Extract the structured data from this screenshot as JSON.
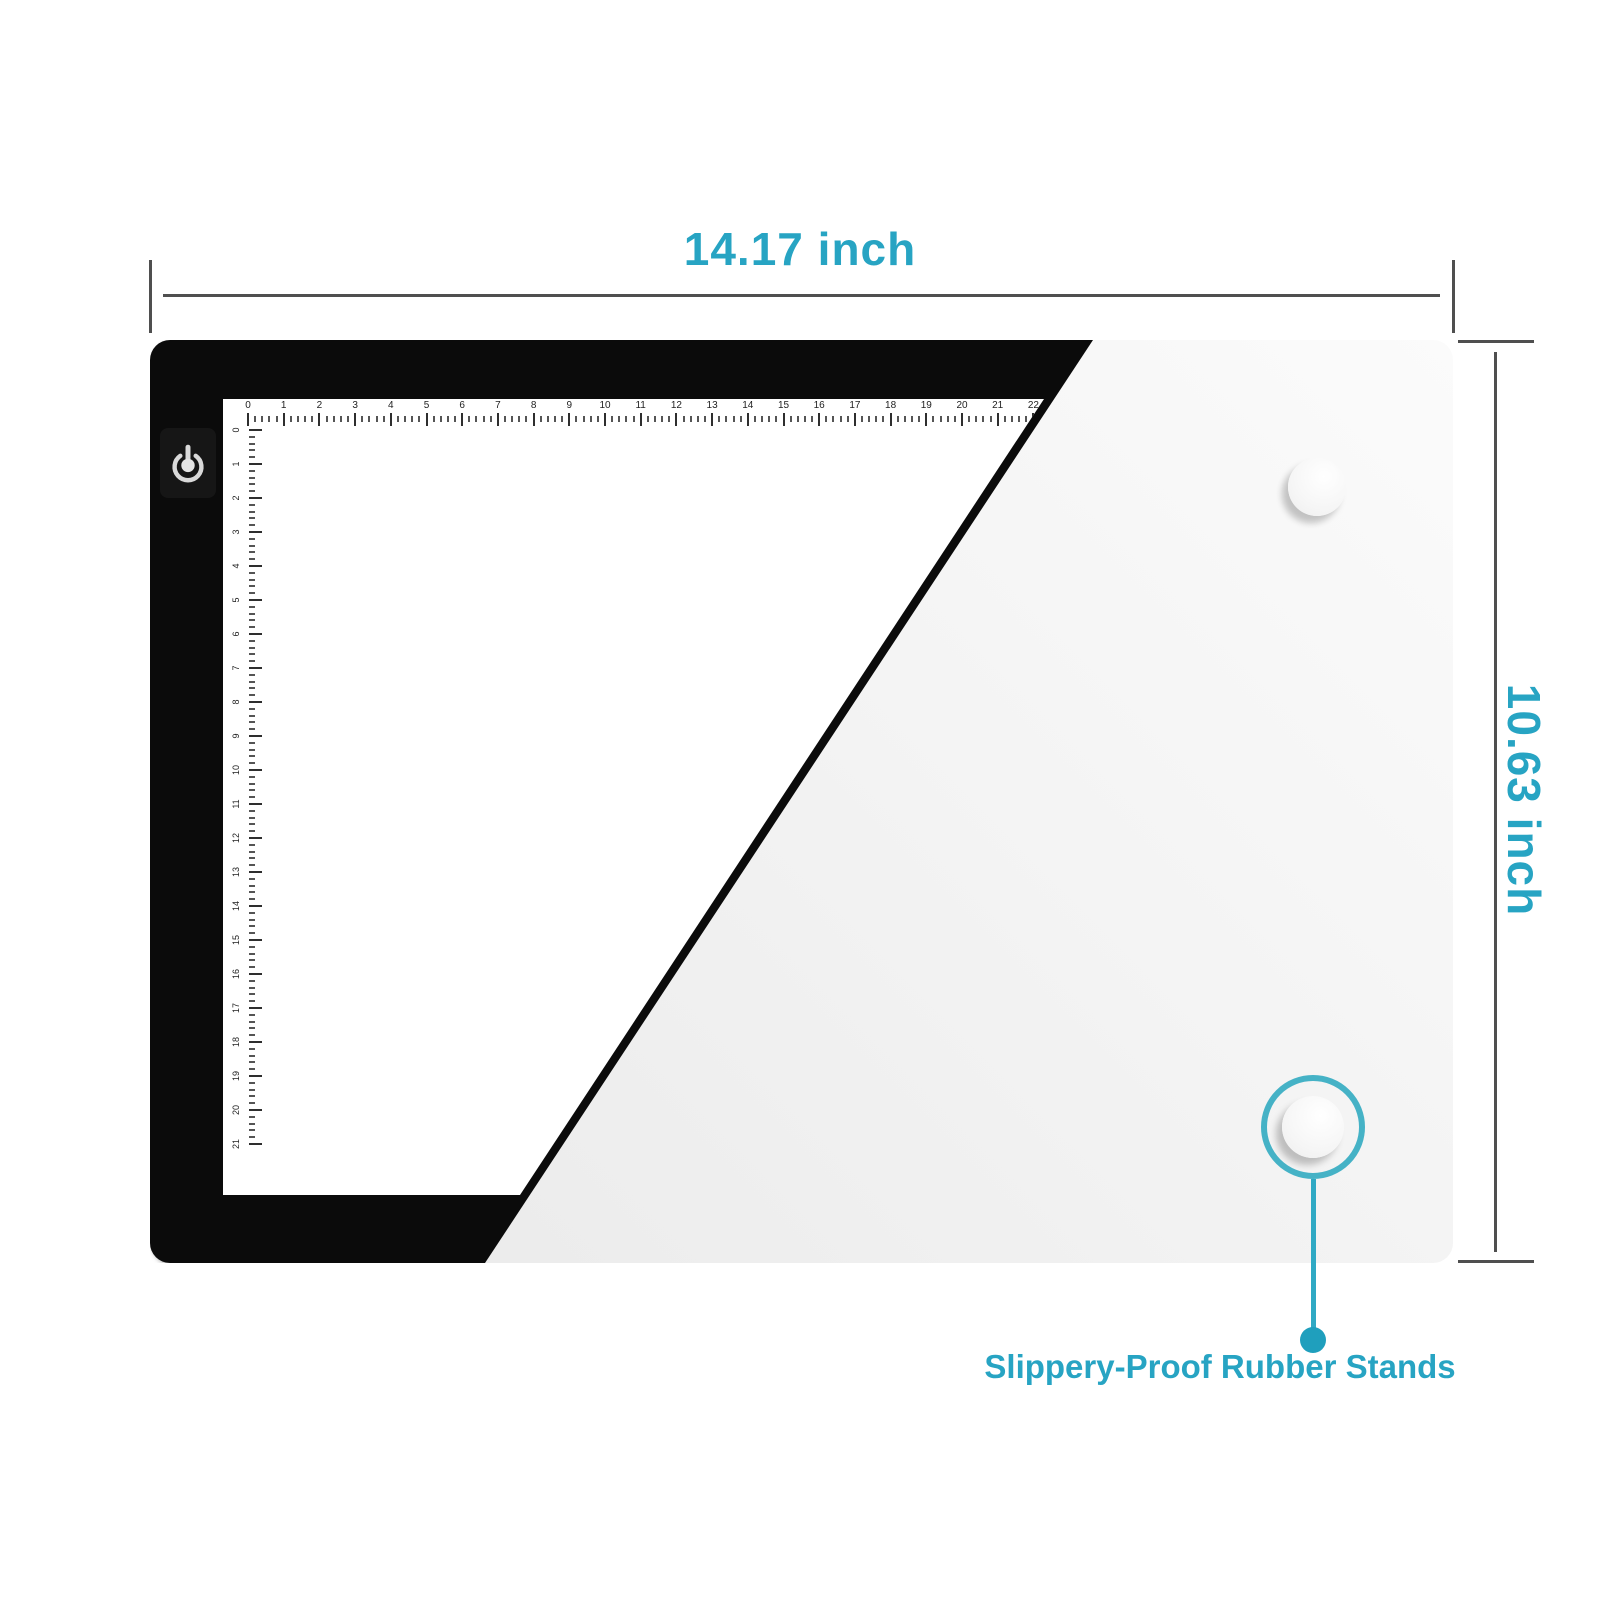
{
  "annotations": {
    "width_label": "14.17 inch",
    "height_label": "10.63 inch",
    "stands_label": "Slippery-Proof Rubber Stands",
    "accent_color": "#27A4C3",
    "dimension_line_color": "#4F4F4F"
  },
  "product": {
    "name": "LED light pad front and back view",
    "front": {
      "power_icon": "power-touch-icon",
      "frame_color": "#0B0B0B",
      "surface_color": "#FFFFFF"
    },
    "back": {
      "color_light": "#FBFBFB",
      "color_dark": "#E9E9E9",
      "stands": [
        "top-right",
        "bottom-right"
      ]
    },
    "rulers": {
      "top": {
        "unit_numbers": [
          0,
          1,
          2,
          3,
          4,
          5,
          6,
          7,
          8,
          9,
          10,
          11,
          12,
          13,
          14,
          15,
          16,
          17,
          18,
          19,
          20,
          21,
          22
        ]
      },
      "left": {
        "unit_numbers": [
          0,
          1,
          2,
          3,
          4,
          5,
          6,
          7,
          8,
          9,
          10,
          11,
          12,
          13,
          14,
          15,
          16,
          17,
          18,
          19,
          20,
          21
        ]
      }
    }
  }
}
